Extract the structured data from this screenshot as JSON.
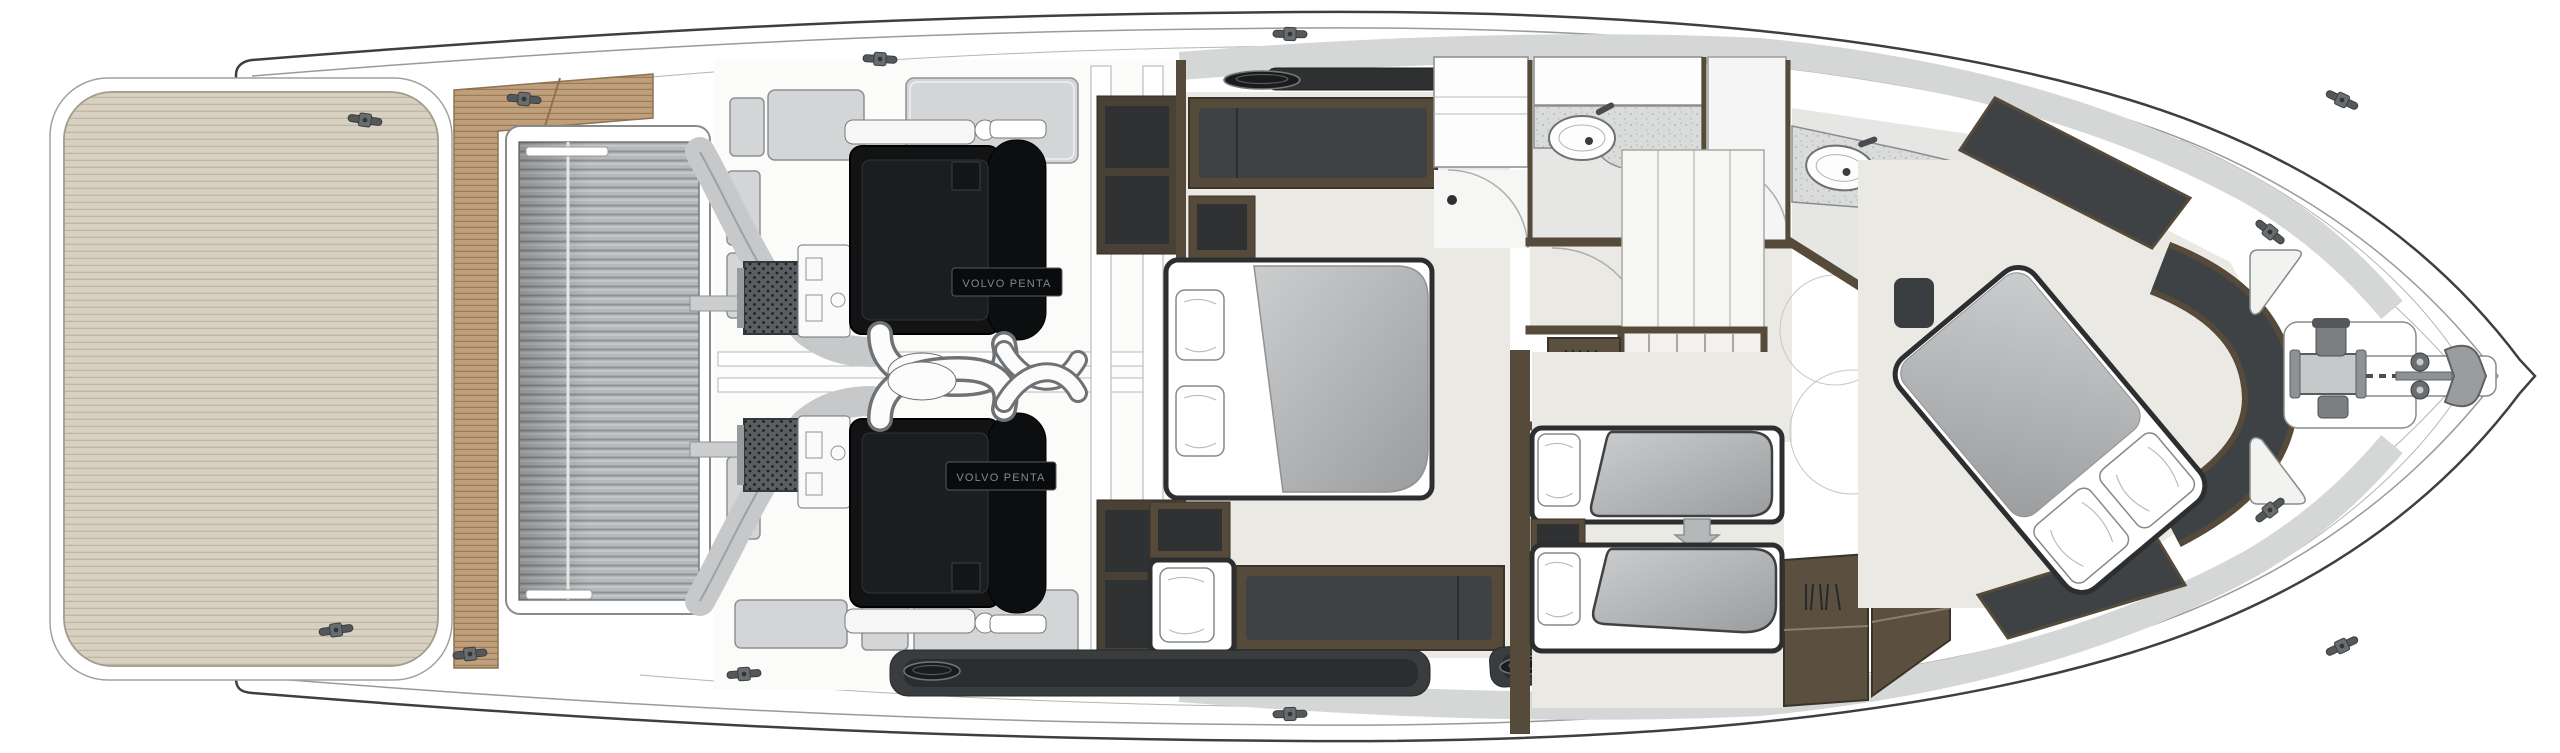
{
  "diagram": {
    "kind": "yacht lower-deck floor plan, top view, stern left and bow right",
    "engine_label": "VOLVO PENTA",
    "engine_count": 2
  },
  "colors": {
    "hull_line": "#3e3f41",
    "thin_line": "#9a9a98",
    "platform": "#d8d1c2",
    "platform_line": "#c0b6a4",
    "teak": "#c09f7c",
    "teak_line": "#9a7c55",
    "slat": "#b6b9bb",
    "slat_line": "#8f9294",
    "box": "#d3d5d7",
    "box_line": "#8e9193",
    "engine": "#121315",
    "floor": "#ebe9e3",
    "floor_bath": "#e6e7e5",
    "charcoal": "#3f4244",
    "brown": "#564a3a",
    "wardrobe": "#5b5040",
    "mattress_light": "#cbcdce",
    "mattress_dark": "#9a9c9e",
    "bed_edge": "#2c2e2f",
    "counter": "#d9dbda",
    "band": "#d5d7d7",
    "window": "#2e3032",
    "metal": "#8f9294",
    "metal_dark": "#4b4e50",
    "arrow": "#b5b7b8"
  },
  "icons": {
    "cleat-icon": "deck mooring cleat (T shape)",
    "porthole-icon": "hull window oval",
    "sink-icon": "oval basin with faucet and drain",
    "toilet-icon": "toilet bowl with tank",
    "shower-door-icon": "quarter-circle shower door swing",
    "stairs-icon": "companionway steps",
    "arrow-down-icon": "sliding-berth direction arrow",
    "hanger-icon": "wardrobe hanger strokes",
    "windlass-icon": "anchor windlass with capstan",
    "anchor-icon": "plough anchor at bow",
    "engine-icon": "inboard diesel engine, top view"
  }
}
